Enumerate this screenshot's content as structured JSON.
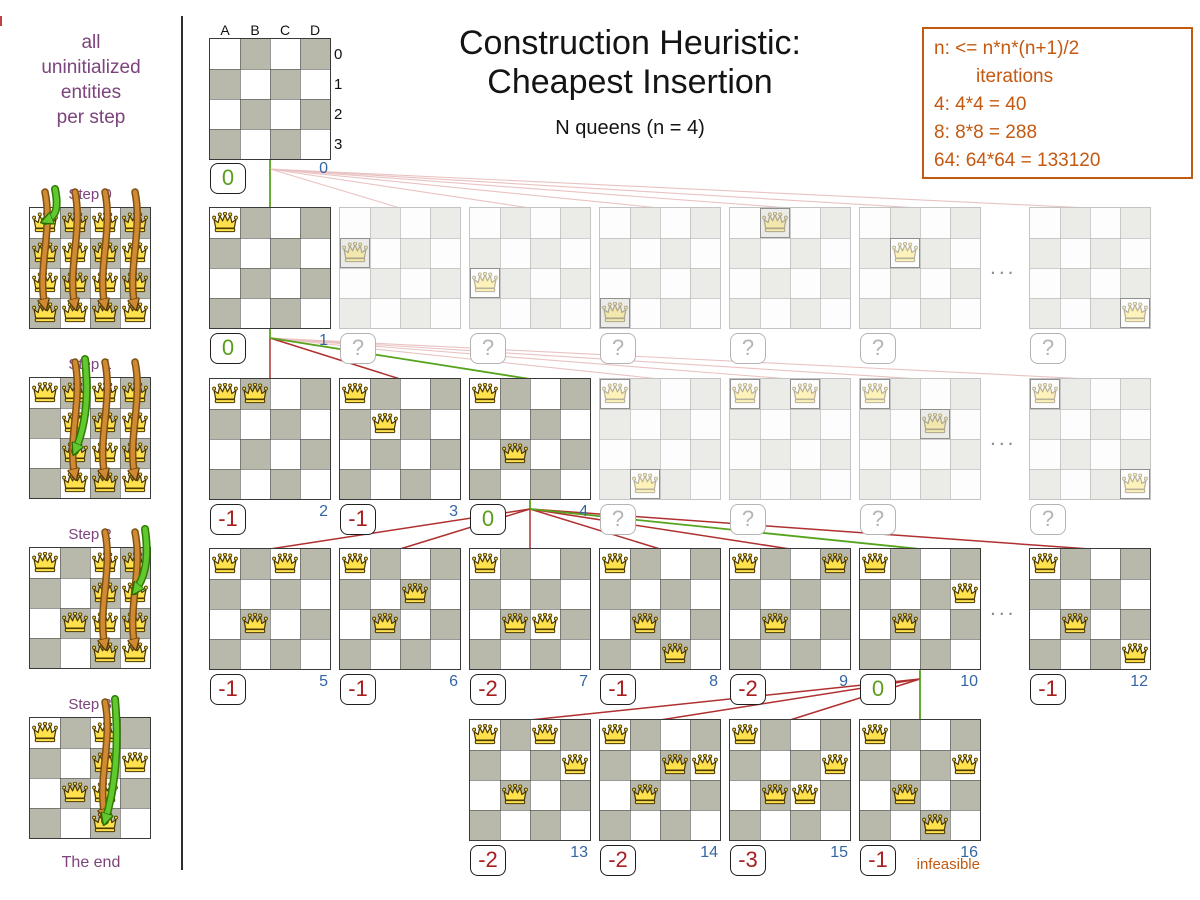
{
  "header": {
    "title_line1": "Construction Heuristic:",
    "title_line2": "Cheapest Insertion",
    "subtitle": "N queens (n = 4)"
  },
  "info_box": {
    "lines": [
      "n: <= n*n*(n+1)/2",
      "iterations",
      "4: 4*4 = 40",
      "8: 8*8 = 288",
      "64: 64*64 = 133120"
    ]
  },
  "sidebar": {
    "intro_lines": [
      "all",
      "uninitialized",
      "entities",
      "per step"
    ],
    "end_label": "The end",
    "steps": [
      {
        "label": "Step 0",
        "fixed": [],
        "trial_columns": [
          "A",
          "B",
          "C",
          "D"
        ],
        "chosen": "A0"
      },
      {
        "label": "Step 1",
        "fixed": [
          "A0"
        ],
        "trial_columns": [
          "B",
          "C",
          "D"
        ],
        "chosen": "B2"
      },
      {
        "label": "Step 2",
        "fixed": [
          "A0",
          "B2"
        ],
        "trial_columns": [
          "C",
          "D"
        ],
        "chosen": "D1"
      },
      {
        "label": "Step 3",
        "fixed": [
          "A0",
          "B2",
          "D1"
        ],
        "trial_columns": [
          "C"
        ],
        "chosen": "C3"
      }
    ]
  },
  "root": {
    "column_labels": [
      "A",
      "B",
      "C",
      "D"
    ],
    "row_labels": [
      "0",
      "1",
      "2",
      "3"
    ],
    "score": "0",
    "iteration": "0"
  },
  "tree_rows": [
    {
      "dots": true,
      "boards": [
        {
          "queens": [
            "A0"
          ],
          "score": "0",
          "iteration": "1",
          "link": "green",
          "faded": false
        },
        {
          "queens": [
            "A1"
          ],
          "score": "?",
          "link": "pink",
          "faded": true
        },
        {
          "queens": [
            "A2"
          ],
          "score": "?",
          "link": "pink",
          "faded": true
        },
        {
          "queens": [
            "A3"
          ],
          "score": "?",
          "link": "pink",
          "faded": true
        },
        {
          "queens": [
            "B0"
          ],
          "score": "?",
          "link": "pink",
          "faded": true
        },
        {
          "queens": [
            "B1"
          ],
          "score": "?",
          "link": "pink",
          "faded": true
        },
        {
          "queens": [
            "D3"
          ],
          "score": "?",
          "link": "pink",
          "faded": true
        }
      ]
    },
    {
      "dots": true,
      "boards": [
        {
          "queens": [
            "A0",
            "B0"
          ],
          "score": "-1",
          "iteration": "2",
          "link": "red",
          "faded": false
        },
        {
          "queens": [
            "A0",
            "B1"
          ],
          "score": "-1",
          "iteration": "3",
          "link": "red",
          "faded": false
        },
        {
          "queens": [
            "A0",
            "B2"
          ],
          "score": "0",
          "iteration": "4",
          "link": "green",
          "faded": false
        },
        {
          "queens": [
            "A0",
            "B3"
          ],
          "score": "?",
          "link": "pink",
          "faded": true
        },
        {
          "queens": [
            "A0",
            "C0"
          ],
          "score": "?",
          "link": "pink",
          "faded": true
        },
        {
          "queens": [
            "A0",
            "C1"
          ],
          "score": "?",
          "link": "pink",
          "faded": true
        },
        {
          "queens": [
            "A0",
            "D3"
          ],
          "score": "?",
          "link": "pink",
          "faded": true
        }
      ]
    },
    {
      "dots": true,
      "boards": [
        {
          "queens": [
            "A0",
            "B2",
            "C0"
          ],
          "score": "-1",
          "iteration": "5",
          "link": "red",
          "faded": false
        },
        {
          "queens": [
            "A0",
            "B2",
            "C1"
          ],
          "score": "-1",
          "iteration": "6",
          "link": "red",
          "faded": false
        },
        {
          "queens": [
            "A0",
            "B2",
            "C2"
          ],
          "score": "-2",
          "iteration": "7",
          "link": "red",
          "faded": false
        },
        {
          "queens": [
            "A0",
            "B2",
            "C3"
          ],
          "score": "-1",
          "iteration": "8",
          "link": "red",
          "faded": false
        },
        {
          "queens": [
            "A0",
            "B2",
            "D0"
          ],
          "score": "-2",
          "iteration": "9",
          "link": "red",
          "faded": false
        },
        {
          "queens": [
            "A0",
            "B2",
            "D1"
          ],
          "score": "0",
          "iteration": "10",
          "link": "green",
          "faded": false
        },
        {
          "queens": [
            "A0",
            "B2",
            "D3"
          ],
          "score": "-1",
          "iteration": "12",
          "link": "red",
          "faded": false
        }
      ]
    },
    {
      "dots": false,
      "boards": [
        {
          "queens": [
            "A0",
            "B2",
            "D1",
            "C0"
          ],
          "score": "-2",
          "iteration": "13",
          "link": "red",
          "faded": false
        },
        {
          "queens": [
            "A0",
            "B2",
            "D1",
            "C1"
          ],
          "score": "-2",
          "iteration": "14",
          "link": "red",
          "faded": false
        },
        {
          "queens": [
            "A0",
            "B2",
            "D1",
            "C2"
          ],
          "score": "-3",
          "iteration": "15",
          "link": "red",
          "faded": false
        },
        {
          "queens": [
            "A0",
            "B2",
            "D1",
            "C3"
          ],
          "score": "-1",
          "iteration": "16",
          "link": "green",
          "faded": false,
          "note": "infeasible"
        }
      ]
    }
  ],
  "labels": {
    "infeasible": "infeasible",
    "dots": "..."
  },
  "colors": {
    "purple": "#7c437c",
    "orange": "#c45911",
    "blue": "#3465a4",
    "score_green": "#5a9e1e",
    "score_red": "#a81e1e",
    "line_green": "#56a31c",
    "line_red": "#b03030",
    "line_pink": "#eac2c2",
    "board_gray": "#b9b9ab",
    "board_gray_faded": "#ebebe7",
    "queen_gold": "#ffe14d",
    "arrow_orange": "#cf8a33",
    "arrow_green": "#61c830"
  }
}
